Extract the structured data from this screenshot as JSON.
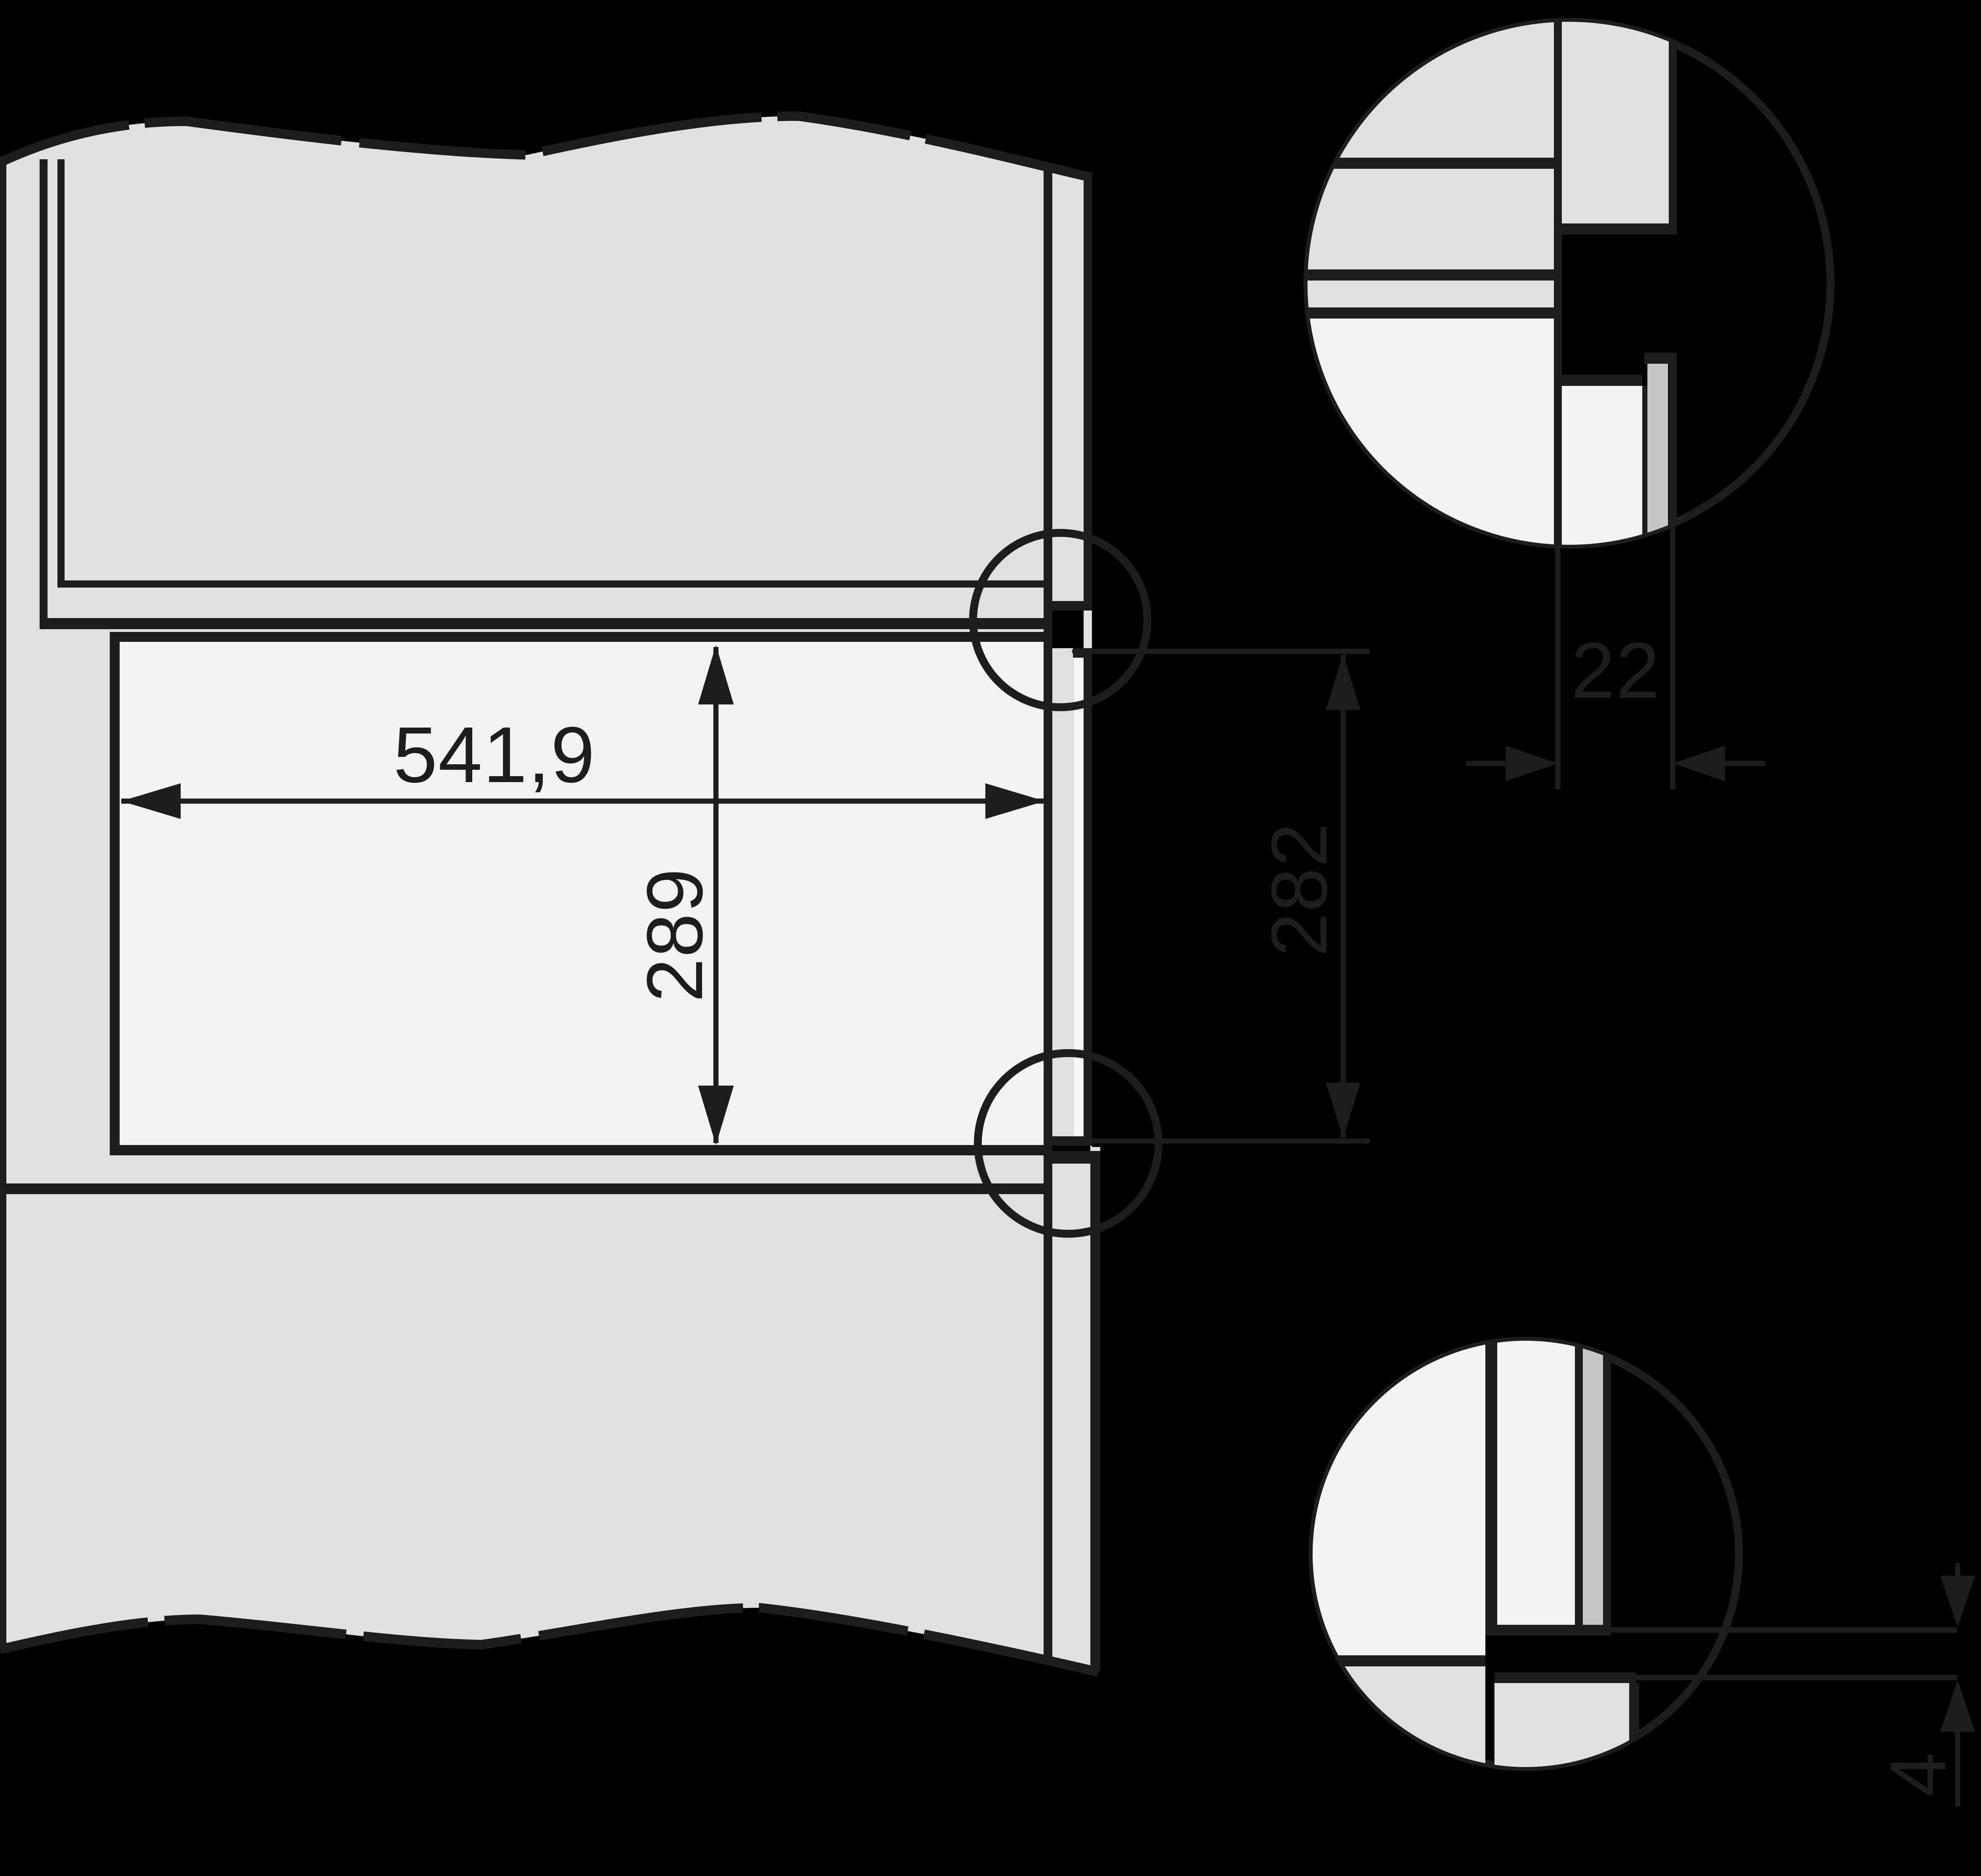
{
  "drawing": {
    "title": "appliance-niche-installation-diagram",
    "dimensions": {
      "niche_width_mm": "541,9",
      "niche_height_mm": "289",
      "front_height_mm": "282",
      "panel_thickness_mm": "22",
      "bottom_gap_mm": "4"
    },
    "colors": {
      "bg": "#000000",
      "line": "#1d1d1b",
      "gray": "#e0e0e0",
      "light": "#f3f3f3",
      "dark": "#c5c5c5",
      "sliver": "#f6f6f6"
    }
  }
}
